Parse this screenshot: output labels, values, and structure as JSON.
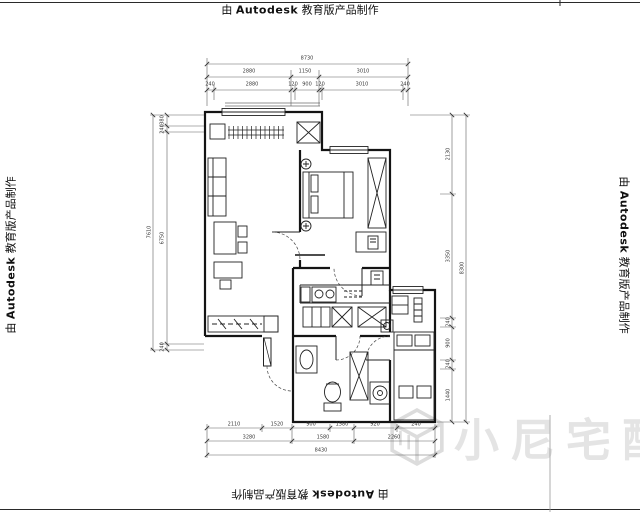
{
  "watermark": {
    "prefix": "由",
    "brand": "Autodesk",
    "suffix": "教育版产品制作"
  },
  "logo_text": "小尼宅配",
  "dims": {
    "top": {
      "total": "8730",
      "row2": [
        "2880",
        "1150",
        "3010"
      ],
      "row3": [
        "240",
        "2880",
        "120",
        "900",
        "120",
        "3010",
        "240"
      ]
    },
    "bottom": {
      "row1": [
        "2110",
        "1520",
        "900",
        "1580",
        "920",
        "240"
      ],
      "row2": [
        "3280",
        "1580",
        "2260"
      ],
      "total": "8430"
    },
    "left": {
      "segments": [
        "380",
        "240",
        "6750",
        "240"
      ],
      "total": "7610"
    },
    "right": {
      "segments": [
        "2130",
        "3350",
        "240",
        "900",
        "240",
        "1440"
      ],
      "total": "8300"
    }
  }
}
